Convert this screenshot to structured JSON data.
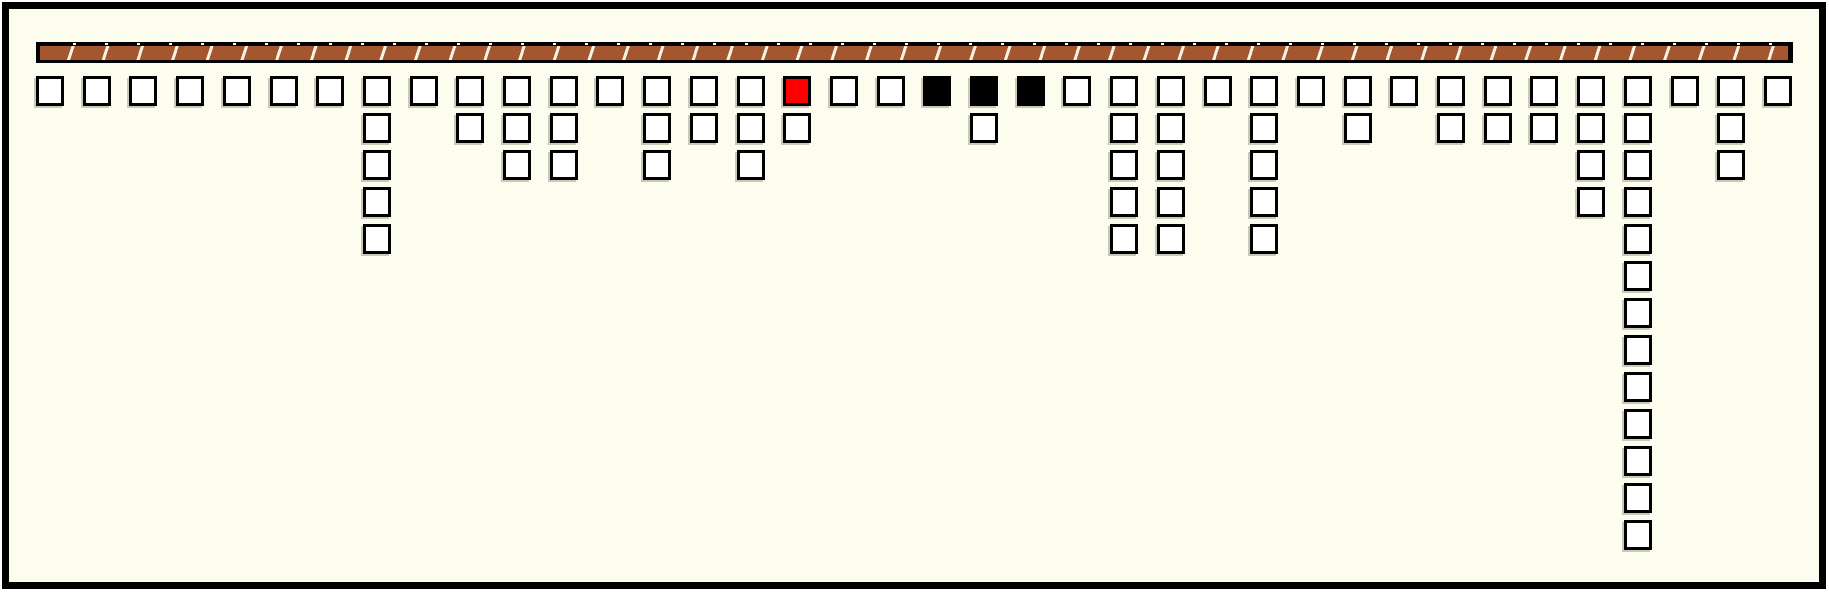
{
  "scene": {
    "description": "separate-chaining bucket diagram hanging from hatched beam",
    "canvas": {
      "width": 1829,
      "height": 592,
      "margin_color": "#FFFFFF",
      "frame_color": "#000000",
      "background": "#FCFCEF"
    },
    "bar": {
      "x": 36,
      "y": 42,
      "width": 1757,
      "height": 21,
      "fill": "#A5562E",
      "slash_color": "#F6F2E6",
      "border_color": "#000000",
      "segment_pitch": 33
    },
    "grid": {
      "origin_x": 36,
      "origin_y": 76,
      "col_pitch": 46.7,
      "row_pitch": 37,
      "square_w": 28,
      "square_h": 30,
      "column_count": 38
    },
    "colors": {
      "square_fill": "#FFFFFF",
      "square_border": "#000000",
      "red": "#FE0000",
      "black": "#000000",
      "shadow": "rgba(150,148,132,0.5)"
    },
    "columns": [
      {
        "index": 0,
        "color": "white",
        "chain": 0
      },
      {
        "index": 1,
        "color": "white",
        "chain": 0
      },
      {
        "index": 2,
        "color": "white",
        "chain": 0
      },
      {
        "index": 3,
        "color": "white",
        "chain": 0
      },
      {
        "index": 4,
        "color": "white",
        "chain": 0
      },
      {
        "index": 5,
        "color": "white",
        "chain": 0
      },
      {
        "index": 6,
        "color": "white",
        "chain": 0
      },
      {
        "index": 7,
        "color": "white",
        "chain": 4
      },
      {
        "index": 8,
        "color": "white",
        "chain": 0
      },
      {
        "index": 9,
        "color": "white",
        "chain": 1
      },
      {
        "index": 10,
        "color": "white",
        "chain": 2
      },
      {
        "index": 11,
        "color": "white",
        "chain": 2
      },
      {
        "index": 12,
        "color": "white",
        "chain": 0
      },
      {
        "index": 13,
        "color": "white",
        "chain": 2
      },
      {
        "index": 14,
        "color": "white",
        "chain": 1
      },
      {
        "index": 15,
        "color": "white",
        "chain": 2
      },
      {
        "index": 16,
        "color": "red",
        "chain": 1
      },
      {
        "index": 17,
        "color": "white",
        "chain": 0
      },
      {
        "index": 18,
        "color": "white",
        "chain": 0
      },
      {
        "index": 19,
        "color": "black",
        "chain": 0
      },
      {
        "index": 20,
        "color": "black",
        "chain": 1
      },
      {
        "index": 21,
        "color": "black",
        "chain": 0
      },
      {
        "index": 22,
        "color": "white",
        "chain": 0
      },
      {
        "index": 23,
        "color": "white",
        "chain": 4
      },
      {
        "index": 24,
        "color": "white",
        "chain": 4
      },
      {
        "index": 25,
        "color": "white",
        "chain": 0
      },
      {
        "index": 26,
        "color": "white",
        "chain": 4
      },
      {
        "index": 27,
        "color": "white",
        "chain": 0
      },
      {
        "index": 28,
        "color": "white",
        "chain": 1
      },
      {
        "index": 29,
        "color": "white",
        "chain": 0
      },
      {
        "index": 30,
        "color": "white",
        "chain": 1
      },
      {
        "index": 31,
        "color": "white",
        "chain": 1
      },
      {
        "index": 32,
        "color": "white",
        "chain": 1
      },
      {
        "index": 33,
        "color": "white",
        "chain": 3
      },
      {
        "index": 34,
        "color": "white",
        "chain": 12
      },
      {
        "index": 35,
        "color": "white",
        "chain": 0
      },
      {
        "index": 36,
        "color": "white",
        "chain": 2
      },
      {
        "index": 37,
        "color": "white",
        "chain": 0
      }
    ]
  }
}
